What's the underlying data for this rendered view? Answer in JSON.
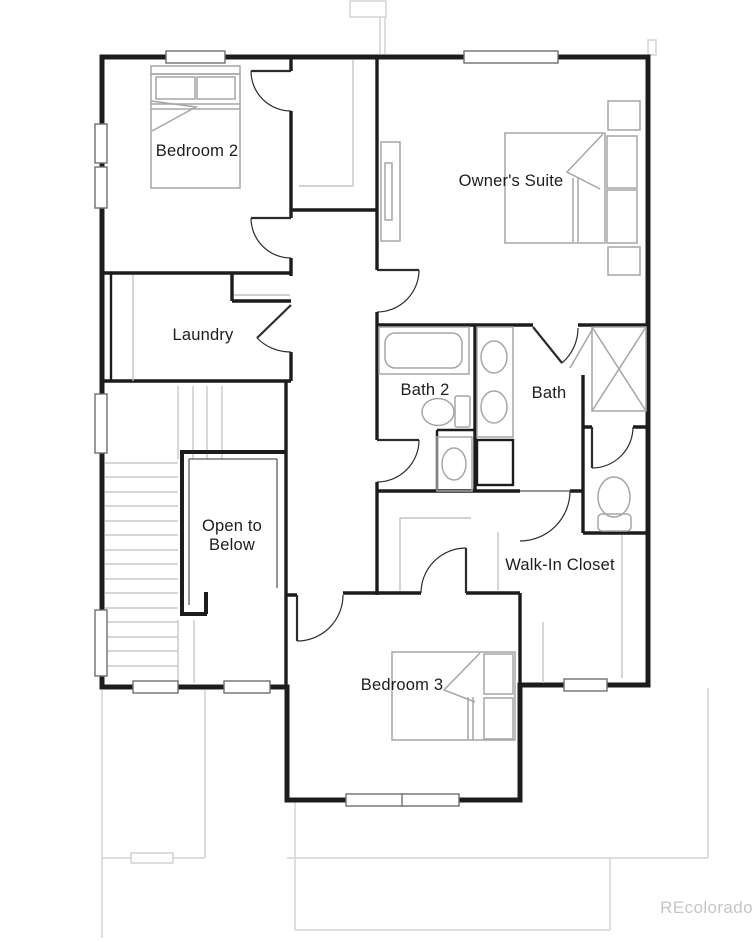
{
  "plan": {
    "type": "residential-floor-plan-upper-level",
    "rooms": {
      "bedroom2": "Bedroom 2",
      "owners_suite": "Owner's Suite",
      "laundry": "Laundry",
      "bath2": "Bath 2",
      "bath": "Bath",
      "open_to_below": "Open to Below",
      "walk_in_closet": "Walk-In Closet",
      "bedroom3": "Bedroom 3"
    },
    "watermark": "REcolorado",
    "colors": {
      "wall": "#1c1c1c",
      "fixture": "#a6a6a6",
      "shelf": "#c4c4c4",
      "stair": "#c9c9c9",
      "ghost": "#dadada",
      "watermark": "#c5c5c5"
    }
  }
}
